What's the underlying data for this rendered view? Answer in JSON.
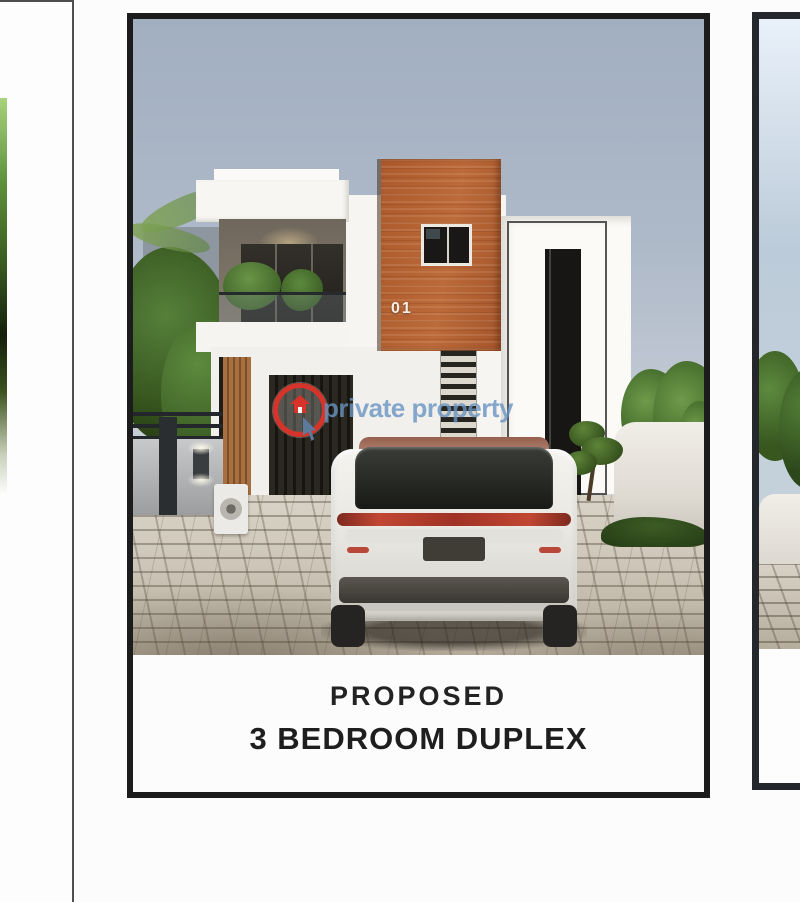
{
  "gallery": {
    "left_card": {
      "note": ""
    },
    "main_card": {
      "unit_number": "01",
      "caption_line1": "PROPOSED",
      "caption_line2": "3 BEDROOM DUPLEX"
    },
    "right_card": {
      "note": ""
    }
  },
  "watermark": {
    "brand_text": "private property",
    "logo": "red-ring-house-with-cursor-icon"
  },
  "colors": {
    "brand_red": "#d6342a",
    "watermark_blue": "#6894c2",
    "brick_accent": "#b15e2f",
    "card_border": "#1c1c1c",
    "caption_text": "#232323"
  }
}
